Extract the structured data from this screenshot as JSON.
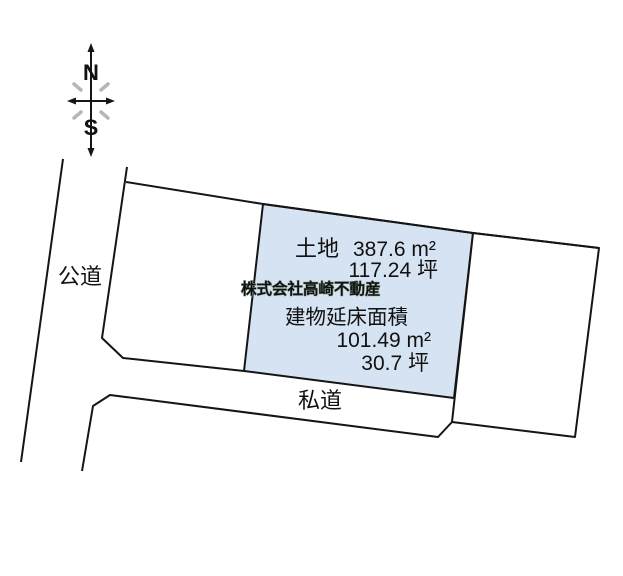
{
  "diagram": {
    "compass": {
      "north": "N",
      "south": "S"
    },
    "labels": {
      "public_road": "公道",
      "private_road": "私道"
    },
    "parcel_info": {
      "land_label": "土地",
      "land_area_m2": "387.6 m²",
      "land_area_tsubo": "117.24 坪",
      "building_label": "建物延床面積",
      "building_area_m2": "101.49 m²",
      "building_area_tsubo": "30.7 坪"
    },
    "watermark": "株式会社高崎不動産",
    "colors": {
      "highlight_parcel_fill": "#d6e3f2",
      "outline": "#151515",
      "compass_letter": "#4a4a4a",
      "compass_dash": "#b6b6b6",
      "watermark_fill": "#ffffff",
      "watermark_outline": "#93a89b"
    }
  }
}
